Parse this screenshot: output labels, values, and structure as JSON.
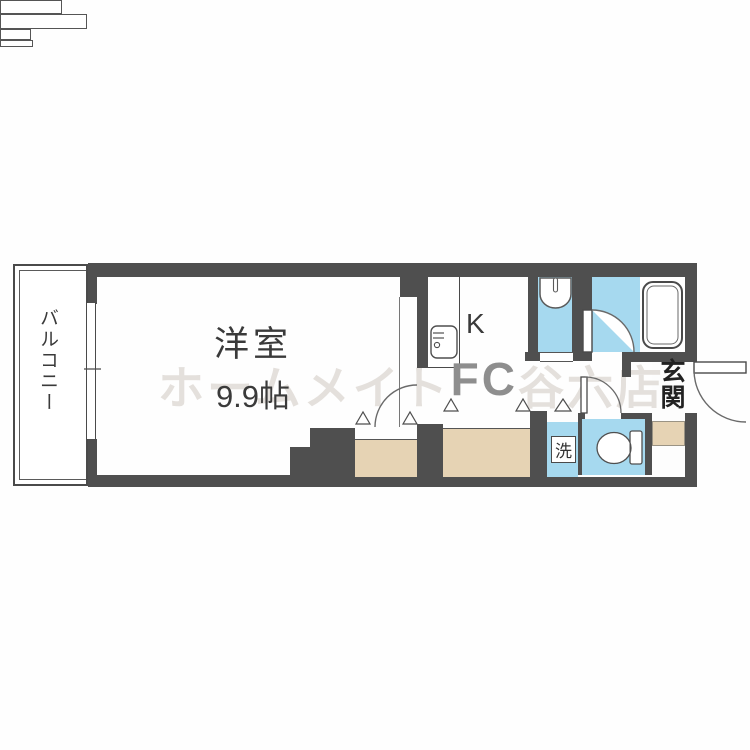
{
  "plan": {
    "type": "japanese-apartment-floorplan",
    "labels": {
      "balcony": "バルコニー",
      "room_name": "洋室",
      "room_size": "9.9帖",
      "kitchen": "K",
      "entrance": "玄関",
      "laundry": "洗"
    },
    "watermark": {
      "part1": "ホームメイト",
      "part2": "FC",
      "part3": "谷六店"
    },
    "colors": {
      "wall": "#4f4f4f",
      "water_area": "#a6d9ef",
      "closet_area": "#e6d3b4",
      "watermark_light": "#e4e0dc",
      "watermark_dark": "#8e8e8e"
    },
    "fixtures": [
      "bathtub",
      "toilet",
      "washbasin",
      "kitchen-sink",
      "washing-machine-space"
    ]
  }
}
